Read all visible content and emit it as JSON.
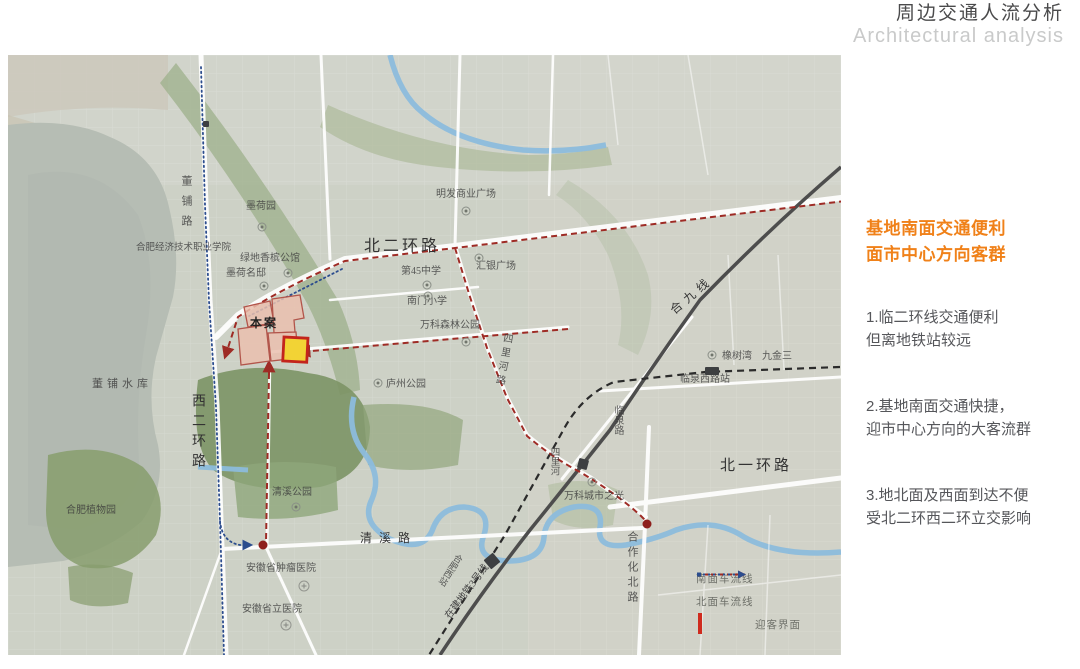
{
  "title": {
    "zh": "周边交通人流分析",
    "en": "Architectural analysis"
  },
  "analysis_panel": {
    "heading": [
      "基地南面交通便利",
      "面市中心方向客群"
    ],
    "heading_color": "#f08119",
    "points": [
      [
        "1.临二环线交通便利",
        "但离地铁站较远"
      ],
      [
        "2.基地南面交通快捷，",
        "迎市中心方向的大客流群"
      ],
      [
        "3.地北面及西面到达不便",
        "受北二环西二环立交影响"
      ]
    ]
  },
  "legend": {
    "items": [
      {
        "key": "south-flow",
        "label": "南面车流线",
        "color": "#9e2b25"
      },
      {
        "key": "north-flow",
        "label": "北面车流线",
        "color": "#2c4d8e"
      },
      {
        "key": "site-face",
        "label": "迎客界面",
        "fill": "#f2d335",
        "border": "#cf2b1e"
      }
    ]
  },
  "map": {
    "labels": [
      {
        "t": "董铺路",
        "x": 172,
        "y": 120,
        "s": 11,
        "v": 1,
        "ls": 9
      },
      {
        "t": "墨荷园",
        "x": 238,
        "y": 147,
        "s": 10
      },
      {
        "t": "合肥经济技术职业学院",
        "x": 128,
        "y": 189,
        "s": 9.5
      },
      {
        "t": "绿地香槟公馆",
        "x": 232,
        "y": 199,
        "s": 10
      },
      {
        "t": "墨荷名邸",
        "x": 218,
        "y": 214,
        "s": 10
      },
      {
        "t": "北二环路",
        "x": 356,
        "y": 184,
        "s": 16,
        "ls": 3,
        "c": "#333333"
      },
      {
        "t": "明发商业广场",
        "x": 428,
        "y": 135,
        "s": 10
      },
      {
        "t": "第45中学",
        "x": 393,
        "y": 212,
        "s": 10
      },
      {
        "t": "汇银广场",
        "x": 468,
        "y": 207,
        "s": 10
      },
      {
        "t": "南门小学",
        "x": 399,
        "y": 242,
        "s": 10
      },
      {
        "t": "万科森林公园",
        "x": 412,
        "y": 266,
        "s": 10
      },
      {
        "t": "四里河路",
        "x": 494,
        "y": 277,
        "s": 10,
        "v": 1,
        "r": 10,
        "ls": 4
      },
      {
        "t": "庐州公园",
        "x": 378,
        "y": 325,
        "s": 10
      },
      {
        "t": "西二环路",
        "x": 182,
        "y": 338,
        "s": 14,
        "v": 1,
        "ls": 6,
        "c": "#333333"
      },
      {
        "t": "董铺水库",
        "x": 84,
        "y": 324,
        "s": 11,
        "ls": 4
      },
      {
        "t": "合肥植物园",
        "x": 58,
        "y": 451,
        "s": 10
      },
      {
        "t": "清溪公园",
        "x": 264,
        "y": 433,
        "s": 10
      },
      {
        "t": "清溪路",
        "x": 352,
        "y": 477,
        "s": 12,
        "ls": 7,
        "c": "#333333"
      },
      {
        "t": "安徽省肿瘤医院",
        "x": 238,
        "y": 509,
        "s": 10
      },
      {
        "t": "安徽省立医院",
        "x": 234,
        "y": 550,
        "s": 10
      },
      {
        "t": "合九线",
        "x": 660,
        "y": 252,
        "s": 12,
        "r": -40,
        "ls": 5,
        "c": "#333333"
      },
      {
        "t": "橡树湾",
        "x": 714,
        "y": 297,
        "s": 10
      },
      {
        "t": "九金三",
        "x": 754,
        "y": 297,
        "s": 10
      },
      {
        "t": "临泉西路站",
        "x": 672,
        "y": 320,
        "s": 10
      },
      {
        "t": "临泉路",
        "x": 604,
        "y": 350,
        "s": 10,
        "v": 1
      },
      {
        "t": "四里河",
        "x": 540,
        "y": 392,
        "s": 9.5,
        "v": 1
      },
      {
        "t": "万科城市之光",
        "x": 556,
        "y": 437,
        "s": 10
      },
      {
        "t": "北一环路",
        "x": 712,
        "y": 404,
        "s": 15,
        "ls": 3,
        "c": "#333333"
      },
      {
        "t": "合作化北路",
        "x": 618,
        "y": 476,
        "s": 11,
        "v": 1,
        "ls": 4
      },
      {
        "t": "在建地铁3号线",
        "x": 436,
        "y": 560,
        "s": 10,
        "r": -53,
        "c": "#444444"
      },
      {
        "t": "合肥西站",
        "x": 448,
        "y": 497,
        "s": 9,
        "v": 1,
        "r": 33
      },
      {
        "t": "本案",
        "x": 242,
        "y": 262,
        "s": 12,
        "c": "#222222",
        "ls": 2,
        "b": 1
      }
    ],
    "icons": [
      {
        "k": "park",
        "x": 254,
        "y": 172
      },
      {
        "k": "park",
        "x": 458,
        "y": 156
      },
      {
        "k": "park",
        "x": 419,
        "y": 230
      },
      {
        "k": "park",
        "x": 471,
        "y": 203
      },
      {
        "k": "park",
        "x": 420,
        "y": 241
      },
      {
        "k": "park",
        "x": 458,
        "y": 287
      },
      {
        "k": "park",
        "x": 370,
        "y": 328
      },
      {
        "k": "park",
        "x": 288,
        "y": 452
      },
      {
        "k": "park",
        "x": 584,
        "y": 427
      },
      {
        "k": "park",
        "x": 704,
        "y": 300
      },
      {
        "k": "park",
        "x": 280,
        "y": 218
      },
      {
        "k": "park",
        "x": 256,
        "y": 231
      },
      {
        "k": "hosp",
        "x": 296,
        "y": 531
      },
      {
        "k": "hosp",
        "x": 278,
        "y": 570
      },
      {
        "k": "station",
        "x": 198,
        "y": 69,
        "w": 6,
        "h": 6
      },
      {
        "k": "station",
        "x": 704,
        "y": 316,
        "w": 14,
        "h": 8
      },
      {
        "k": "station",
        "x": 575,
        "y": 409,
        "w": 10,
        "h": 10,
        "r": 15
      },
      {
        "k": "station",
        "x": 484,
        "y": 506,
        "w": 12,
        "h": 12,
        "r": -40
      },
      {
        "k": "dot",
        "x": 255,
        "y": 490
      },
      {
        "k": "dot",
        "x": 639,
        "y": 469
      }
    ],
    "colors": {
      "south_flow": "#9e2b25",
      "north_flow": "#2c4d8e",
      "site_fill": "#eabfae",
      "site_stroke": "#b2554b",
      "gate_fill": "#f2d335",
      "gate_border": "#c3241c",
      "water": "#b6bdb4",
      "river": "#8cbcdc",
      "railway": "#4d4d4d"
    }
  }
}
